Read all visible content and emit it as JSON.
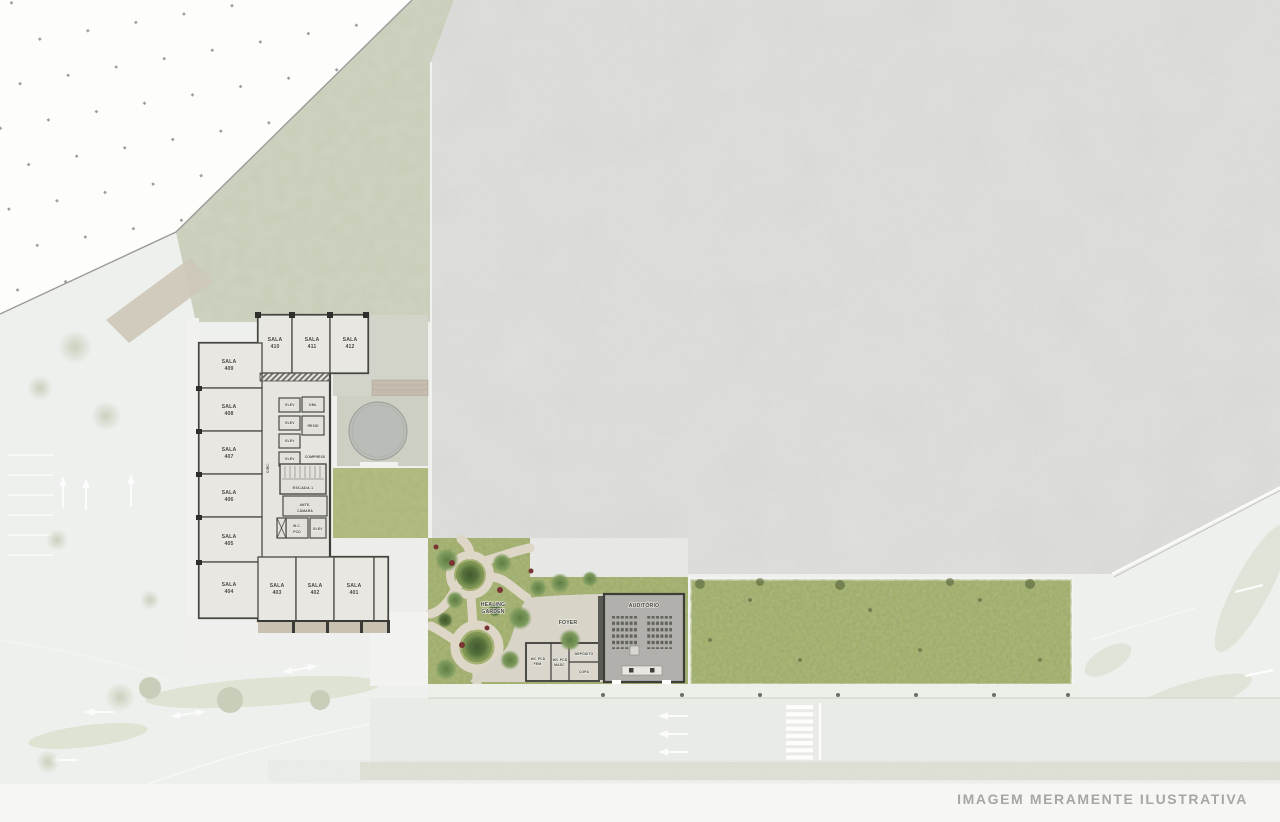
{
  "watermark": "IMAGEM MERAMENTE ILUSTRATIVA",
  "building": {
    "rooms": [
      {
        "label": "SALA",
        "number": "410"
      },
      {
        "label": "SALA",
        "number": "411"
      },
      {
        "label": "SALA",
        "number": "412"
      },
      {
        "label": "SALA",
        "number": "409"
      },
      {
        "label": "SALA",
        "number": "408"
      },
      {
        "label": "SALA",
        "number": "407"
      },
      {
        "label": "SALA",
        "number": "406"
      },
      {
        "label": "SALA",
        "number": "405"
      },
      {
        "label": "SALA",
        "number": "404"
      },
      {
        "label": "SALA",
        "number": "403"
      },
      {
        "label": "SALA",
        "number": "402"
      },
      {
        "label": "SALA",
        "number": "401"
      }
    ],
    "core": {
      "elev": "ELEV",
      "dml": "DML",
      "resid": "RESID",
      "compress": "COMPRESS",
      "escada": "ESCADA 1",
      "circ": "CIRC.",
      "ante_line1": "ANTE-",
      "ante_line2": "CÂMARA",
      "wc_line1": "W.C.",
      "wc_line2": "PCD"
    }
  },
  "amenities": {
    "healing_line1": "HEALING",
    "healing_line2": "GARDEN",
    "foyer": "FOYER",
    "auditorio": "AUDITÓRIO",
    "wc_fem_line1": "WC PCD",
    "wc_fem_line2": "FEM.",
    "wc_masc_line1": "WC PCD",
    "wc_masc_line2": "MASC.",
    "deposito": "DEPÓSITO",
    "copa": "COPA"
  },
  "colors": {
    "base": "#eef0ed",
    "roof": "#dbdcd9",
    "sage_lawn": "#c8cdb9",
    "grass": "#9aa862",
    "garden_path": "#ded7c7",
    "walls": "#3d3d39",
    "floor": "#e7e5e0",
    "road": "#e9ebe6",
    "watermark_text": "#a6a7a4"
  }
}
